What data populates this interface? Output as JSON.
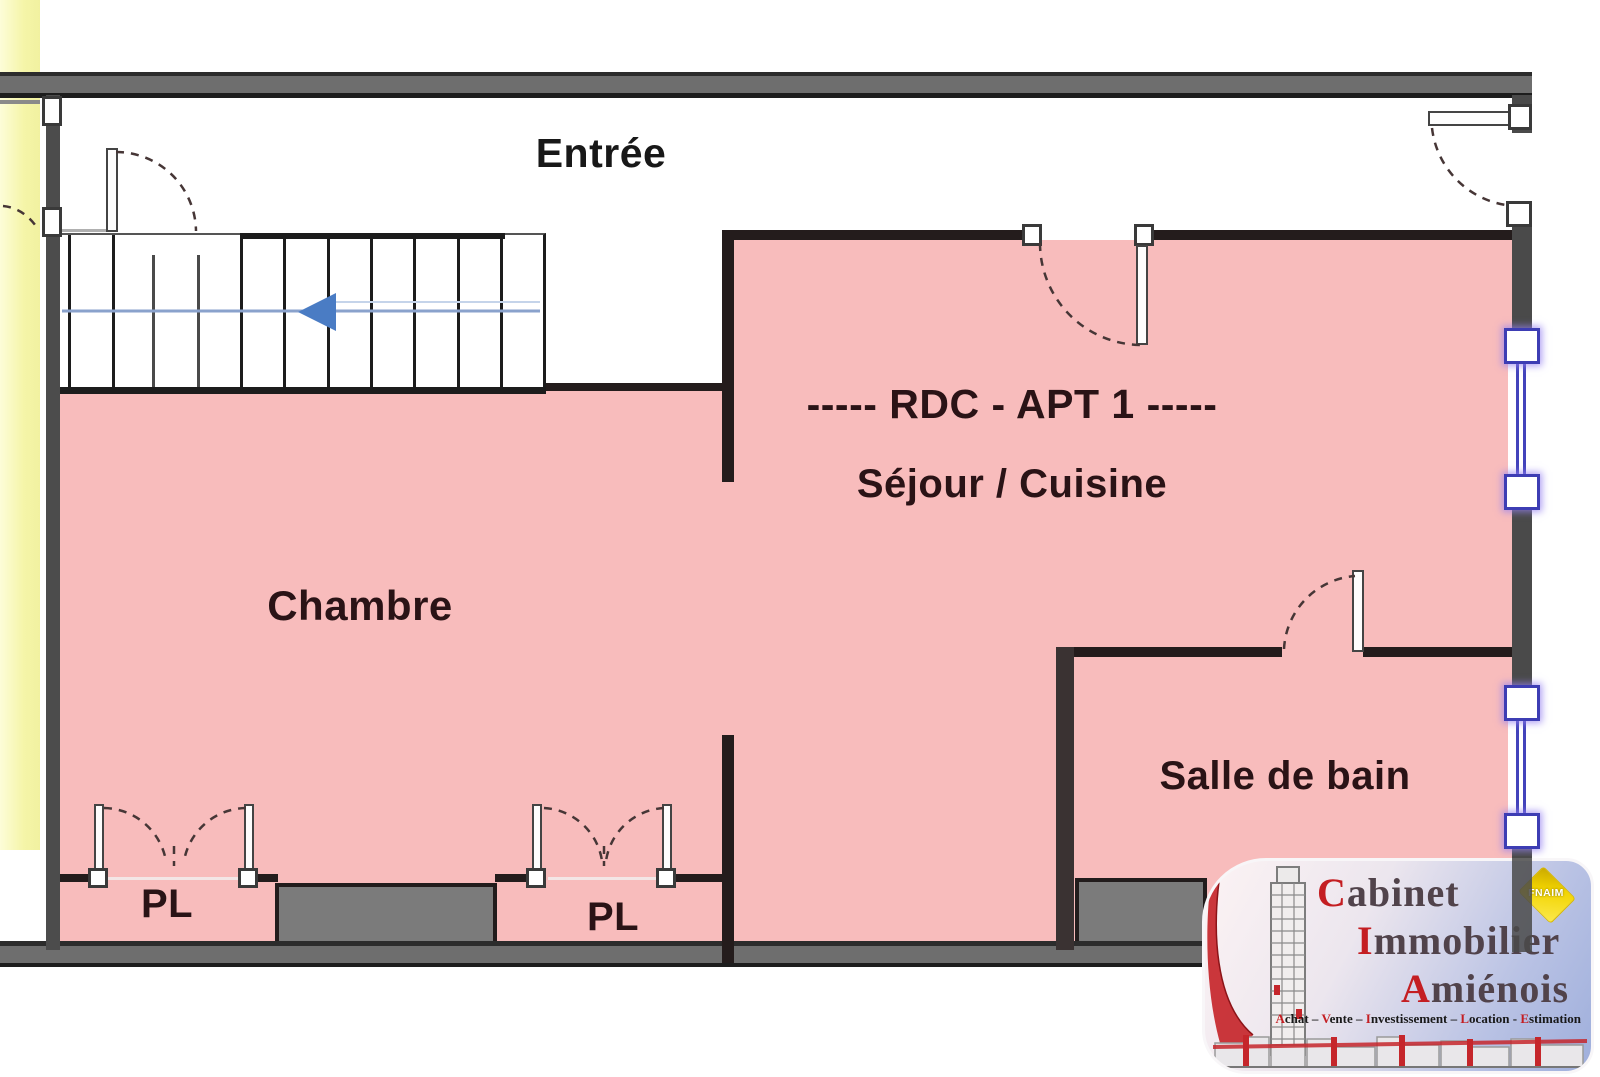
{
  "floorplan": {
    "title_line": "-----  RDC - APT 1  -----",
    "rooms": [
      {
        "id": "entree",
        "label": "Entrée"
      },
      {
        "id": "chambre",
        "label": "Chambre"
      },
      {
        "id": "sejour_cuisine",
        "label": "Séjour / Cuisine"
      },
      {
        "id": "salle_de_bain",
        "label": "Salle de bain"
      },
      {
        "id": "placard_1",
        "label": "PL"
      },
      {
        "id": "placard_2",
        "label": "PL"
      }
    ],
    "colors": {
      "apartment_fill": "#f8bcbc",
      "adjacent_unit_fill": "#f5f5a8",
      "wall_gray": "#4a4a4a",
      "wall_dark": "#241c1c",
      "closet_block": "#7b7b7b",
      "label_text": "#2a1316",
      "stair_arrow_blue": "#4a7cc4",
      "window_frame_blue": "#3d3db4"
    }
  },
  "logo": {
    "brand": [
      {
        "initial": "C",
        "rest": "abinet"
      },
      {
        "initial": "I",
        "rest": "mmobilier"
      },
      {
        "initial": "A",
        "rest": "miénois"
      }
    ],
    "tagline": [
      {
        "initial": "A",
        "rest": "chat",
        "sep": " – "
      },
      {
        "initial": "V",
        "rest": "ente",
        "sep": " – "
      },
      {
        "initial": "I",
        "rest": "nvestissement",
        "sep": " – "
      },
      {
        "initial": "L",
        "rest": "ocation",
        "sep": " - "
      },
      {
        "initial": "E",
        "rest": "stimation",
        "sep": ""
      }
    ],
    "badge": "FNAIM",
    "colors": {
      "brand_text": "#51434b",
      "initial_red": "#c41e22",
      "badge_yellow": "#f2d400",
      "tower_red": "#c5262b"
    }
  }
}
